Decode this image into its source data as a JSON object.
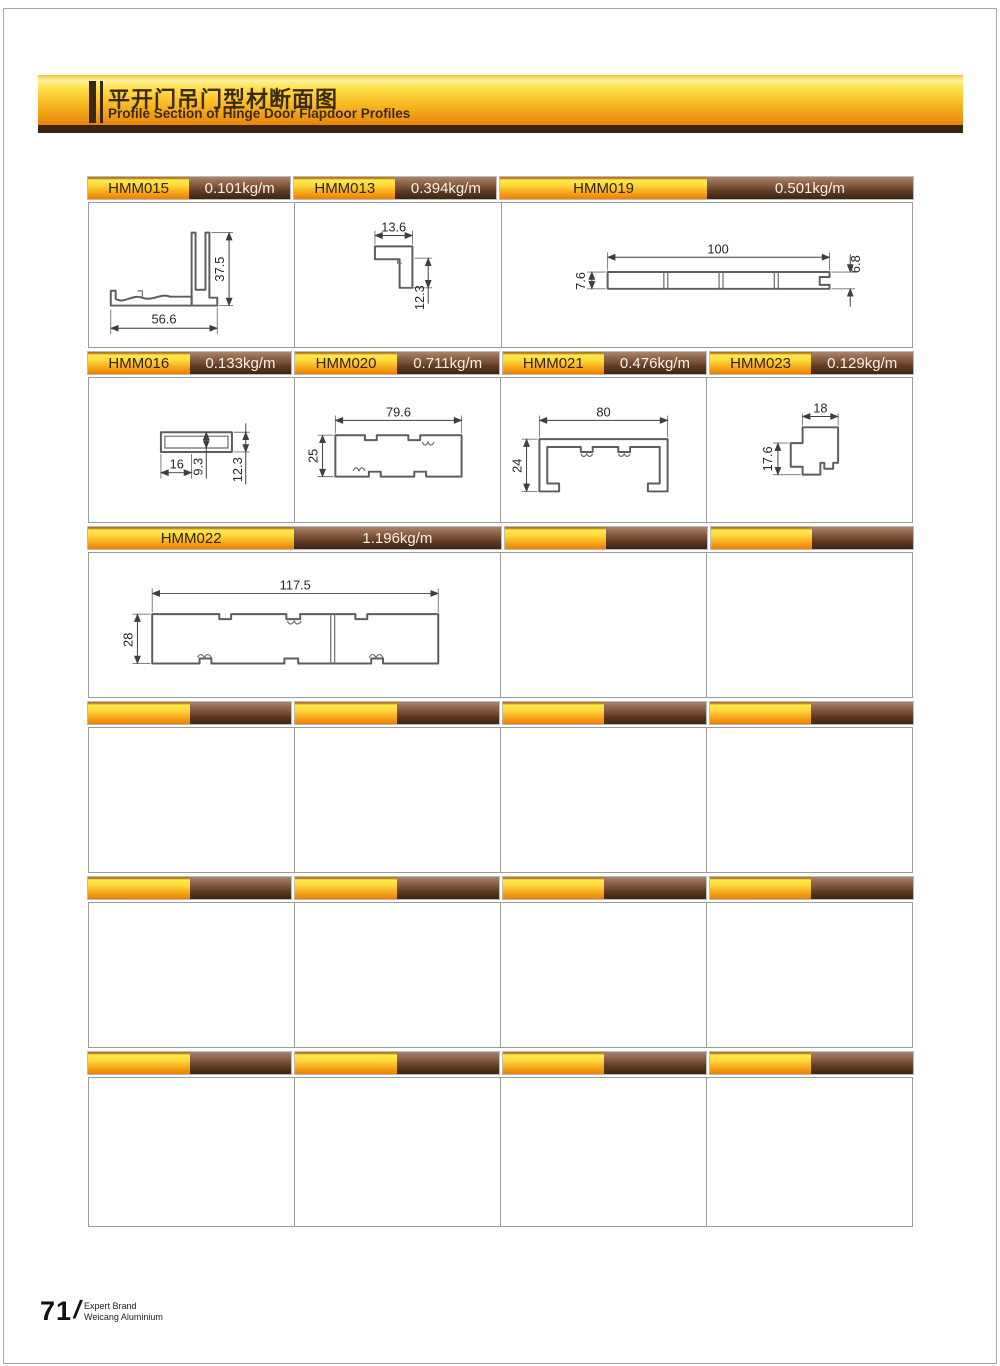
{
  "header": {
    "title_zh": "平开门吊门型材断面图",
    "title_en": "Profile Section of Hinge Door Flapdoor Profiles"
  },
  "footer": {
    "page_number": "71",
    "slash": "/",
    "brand_line1": "Expert Brand",
    "brand_line2": "Weicang Aluminium"
  },
  "colors": {
    "gold_top": "#ffe94d",
    "gold_bottom": "#ee7d00",
    "brown_top": "#a8846d",
    "brown_bottom": "#3f240f",
    "banner_strip": "#3a2511",
    "grid_border": "#9c9c9c"
  },
  "profiles": {
    "hmm015": {
      "code": "HMM015",
      "weight": "0.101kg/m",
      "dim_width": "56.6",
      "dim_height": "37.5"
    },
    "hmm013": {
      "code": "HMM013",
      "weight": "0.394kg/m",
      "dim_width": "13.6",
      "dim_height": "12.3"
    },
    "hmm019": {
      "code": "HMM019",
      "weight": "0.501kg/m",
      "dim_width": "100",
      "dim_left_height": "7.6",
      "dim_right_height": "6.8"
    },
    "hmm016": {
      "code": "HMM016",
      "weight": "0.133kg/m",
      "dim_width": "16",
      "dim_inner_height": "9.3",
      "dim_height": "12.3"
    },
    "hmm020": {
      "code": "HMM020",
      "weight": "0.711kg/m",
      "dim_width": "79.6",
      "dim_height": "25"
    },
    "hmm021": {
      "code": "HMM021",
      "weight": "0.476kg/m",
      "dim_width": "80",
      "dim_height": "24"
    },
    "hmm023": {
      "code": "HMM023",
      "weight": "0.129kg/m",
      "dim_width": "18",
      "dim_height": "17.6"
    },
    "hmm022": {
      "code": "HMM022",
      "weight": "1.196kg/m",
      "dim_width": "117.5",
      "dim_height": "28"
    }
  }
}
